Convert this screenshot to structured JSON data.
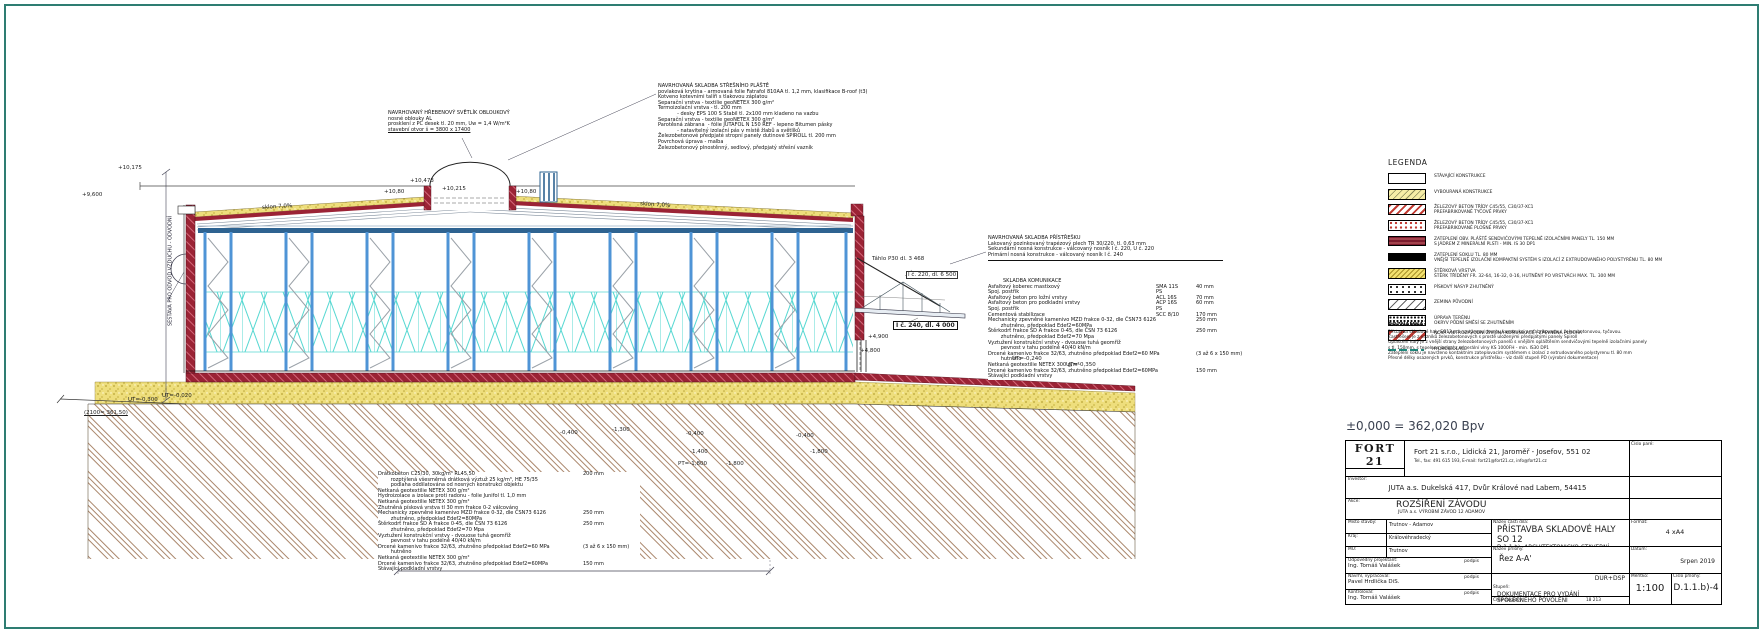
{
  "annotations": {
    "left_note": "SESTAVA PRO ODVOD VZDUCHU - ODVODNÍ",
    "svetlik": {
      "lines": [
        "NAVRHOVANÝ HŘEBENOVÝ SVĚTLÍK OBLOUKOVÝ",
        "nosné oblouky AL",
        "prosklení z PC desek tl. 20 mm, Uw = 1,4 W/m²K",
        "stavební otvor š = 3800 x 17400"
      ]
    },
    "stresni_plast": {
      "lines": [
        "NAVRHOVANÁ SKLADBA STŘEŠNÍHO PLÁŠTĚ",
        "povlaková krytina - armovaná folie Fatrafol 810AA tl. 1,2 mm, klasifikace B-roof (t3)",
        "Kotveno kotevními talíři s tlakovou záplatou",
        "Separační vrstva - textilie geoNETEX 300 g/m²",
        "Termoizolační vrstva - tl. 200 mm",
        "            - desky EPS 100 S Stabil tl. 2x100 mm kladeno na vazbu",
        "Separační vrstva - textilie geoNETEX 300 g/m²",
        "Parotěsná zábrana  - fólie JUTAFOL N 150 REF - lepeno Bitumen pásky",
        "            - natavitelný izolační pás v místě žlabů a světlíků",
        "Železobetonové předpjaté stropní panely dutinové SPIROLL tl. 200 mm",
        "Povrchová úprava - malba",
        "Železobetonový plnostěnný, sedlový, předpjatý střešní vazník"
      ]
    },
    "pristresek": {
      "lines": [
        "NAVRHOVANÁ SKLADBA PŘÍSTŘEŠKU",
        "Lakovaný pozinkovaný trapézový plech TR 30/220, tl. 0,63 mm",
        "Sekundární nosná konstrukce - válcovaný nosník I č. 220, U č. 220",
        "Primární nosná konstrukce - válcovaný nosník I č. 240"
      ]
    },
    "komunikace": {
      "title": "SKLADBA KOMUNIKACE",
      "lines": [
        {
          "t": "Asfaltový koberec mastixový",
          "c": "SMA 11S",
          "v": "40 mm"
        },
        {
          "t": "Spoj. postřik",
          "c": "PS"
        },
        {
          "t": "Asfaltový beton pro ložní vrstvy",
          "c": "ACL 16S",
          "v": "70 mm"
        },
        {
          "t": "Asfaltový beton pro podkladní vrstvy",
          "c": "ACP 16S",
          "v": "60 mm"
        },
        {
          "t": "Spoj. postřik",
          "c": "PS"
        },
        {
          "t": "Cementová stabilizace",
          "c": "SCC 8/10",
          "v": "170 mm"
        },
        {
          "t": "Mechanicky zpevněné kamenivo MZD frakce 0-32, dle ČSN73 6126",
          "v": "250 mm"
        },
        {
          "t": "        zhutněno, předpoklad Edef2=60MPa"
        },
        {
          "t": "Štěrkodrť frakce ŠD A frakce 0-45, dle ČSN 73 6126",
          "v": "250 mm"
        },
        {
          "t": "        zhutněno, předpoklad Edef2=70 Mpa"
        },
        {
          "t": "Vyztužení konstrukční vrstvy - dvouose tuhá geomříž"
        },
        {
          "t": "        pevnost v tahu podélně 40/40 kN/m"
        },
        {
          "t": "Drcené kamenivo frakce 32/63, zhutněno předpoklad Edef2=60 MPa",
          "v": "(3 až 6 x 150 mm)"
        },
        {
          "t": "        hutněno"
        },
        {
          "t": "Netkaná geotextilie NETEX 300 g/m²"
        },
        {
          "t": "Drcené kamenivo frakce 32/63, zhutněno předpoklad Edef2=60MPa",
          "v": "150 mm"
        },
        {
          "t": "Stávající podkladní vrstvy"
        }
      ]
    },
    "podlaha": {
      "lines": [
        {
          "t": "Drátkobeton C25/30, 30kg/m³ RL45,50",
          "v": "200 mm"
        },
        {
          "t": "        rozptýlená všesměrná drátková výztuž 25 kg/m³, HE 75/35"
        },
        {
          "t": "        podlaha oddilatována od nosných konstrukcí objektu"
        },
        {
          "t": "Netkaná geotextilie NETEX 300 g/m²"
        },
        {
          "t": "Hydroizolace a izolace proti radonu - folie Junifol tl. 1,0 mm"
        },
        {
          "t": "Netkaná geotextilie NETEX 300 g/m²"
        },
        {
          "t": "Zhutněná písková vrstva tl 30 mm frakce 0-2 válcováno"
        },
        {
          "t": "Mechanicky zpevněné kamenivo MZD frakce 0-32, dle ČSN73 6126",
          "v": "250 mm"
        },
        {
          "t": "        zhutněno, předpoklad Edef2=80MPa"
        },
        {
          "t": "Štěrkodrť frakce ŠD A frakce 0-45, dle ČSN 73 6126",
          "v": "250 mm"
        },
        {
          "t": "        zhutněno, předpoklad Edef2=70 Mpa"
        },
        {
          "t": "Vyztužení konstrukční vrstvy - dvouose tuhá geomříž"
        },
        {
          "t": "        pevnost v tahu podélně 40/40 kN/m"
        },
        {
          "t": "Drcené kamenivo frakce 32/63, zhutněno předpoklad Edef2=60 MPa",
          "v": "(3 až 6 x 150 mm)"
        },
        {
          "t": "        hutněno"
        },
        {
          "t": "Netkaná geotextilie NETEX 300 g/m²"
        },
        {
          "t": "Drcené kamenivo frakce 32/63, zhutněno předpoklad Edef2=60MPa",
          "v": "150 mm"
        },
        {
          "t": "Stávající podkladní vrstvy"
        }
      ]
    }
  },
  "drawing": {
    "labels": [
      {
        "x": 118,
        "y": 165,
        "t": "+10,175"
      },
      {
        "x": 82,
        "y": 192,
        "t": "+9,600"
      },
      {
        "x": 262,
        "y": 204,
        "t": "sklon 7,0%",
        "style": "rotl"
      },
      {
        "x": 640,
        "y": 202,
        "t": "sklon 7,0%",
        "style": "rotr"
      },
      {
        "x": 410,
        "y": 178,
        "t": "+10,473"
      },
      {
        "x": 442,
        "y": 186,
        "t": "+10,215"
      },
      {
        "x": 384,
        "y": 189,
        "t": "+10,80"
      },
      {
        "x": 516,
        "y": 189,
        "t": "+10,80"
      },
      {
        "x": 872,
        "y": 256,
        "t": "Táhlo P30 dl. 3 468"
      },
      {
        "x": 906,
        "y": 271,
        "t": "I č. 220, dl. 6 500",
        "style": "boxed"
      },
      {
        "x": 893,
        "y": 321,
        "t": "I č. 240, dl. 4 000",
        "style": "boxed-bold"
      },
      {
        "x": 868,
        "y": 334,
        "t": "+4,900"
      },
      {
        "x": 860,
        "y": 348,
        "t": "+4,800"
      },
      {
        "x": 128,
        "y": 397,
        "t": "UT=-0,300"
      },
      {
        "x": 162,
        "y": 393,
        "t": "UT=-0,020"
      },
      {
        "x": 84,
        "y": 410,
        "t": "(2100= 361,50)",
        "style": "ul"
      },
      {
        "x": 560,
        "y": 430,
        "t": "-0,400"
      },
      {
        "x": 612,
        "y": 427,
        "t": "-1,300"
      },
      {
        "x": 686,
        "y": 431,
        "t": "-0,400"
      },
      {
        "x": 690,
        "y": 449,
        "t": "-1,400"
      },
      {
        "x": 678,
        "y": 461,
        "t": "PT=-1,800"
      },
      {
        "x": 726,
        "y": 461,
        "t": "-1,800"
      },
      {
        "x": 796,
        "y": 433,
        "t": "-0,400"
      },
      {
        "x": 810,
        "y": 449,
        "t": "-1,800"
      },
      {
        "x": 1012,
        "y": 356,
        "t": "UT=-0,240"
      },
      {
        "x": 1066,
        "y": 362,
        "t": "UT=-0,350"
      }
    ]
  },
  "legend": {
    "title": "LEGENDA",
    "items": [
      {
        "swatch": "existing",
        "lines": [
          "STÁVAJÍCÍ KONSTRUKCE"
        ]
      },
      {
        "swatch": "demolished",
        "lines": [
          "VYBOURANÁ KONSTRUKCE"
        ]
      },
      {
        "swatch": "rc-linear",
        "lines": [
          "ŽELEZOVÝ BETON TŘÍDY C45/55, C30/37-XC1",
          "PREFABRIKOVANÉ TYČOVÉ PRVKY"
        ]
      },
      {
        "swatch": "rc-planar",
        "lines": [
          "ŽELEZOVÝ BETON TŘÍDY C45/55, C30/37-XC1",
          "PREFABRIKOVANÉ PLOŠNÉ PRVKY"
        ]
      },
      {
        "swatch": "sandwich",
        "lines": [
          "ZATEPLENÍ OBV. PLÁŠTĚ SENDVIČOVÝMI TEPELNĚ IZOLAČNÍMI PANELY TL. 150 MM",
          "S JÁDREM Z MINERÁLNÍ PLSTI - MIN. IS 30 DP1"
        ]
      },
      {
        "swatch": "plinth",
        "lines": [
          "ZATEPLENÍ SOKLU TL. 80 MM",
          "VNĚJŠÍ TEPELNĚ IZOLAČNÍ KOMPAKTNÍ SYSTÉM S IZOLACÍ Z EXTRUDOVANÉHO POLYSTYRÉNU TL. 80 MM"
        ]
      },
      {
        "swatch": "gravel",
        "lines": [
          "ŠTĚRKOVÁ VRSTVA",
          "ŠTĚRK TŘÍDĚNÝ FR. 32-64, 16-32, 0-16, HUTNĚNÝ PO VRSTVÁCH MAX. TL. 300 MM"
        ]
      },
      {
        "swatch": "sand",
        "lines": [
          "PÍSKOVÝ NÁSYP ZHUTNĚNÝ"
        ]
      },
      {
        "swatch": "soil",
        "lines": [
          "ZEMINA PŮVODNÍ"
        ]
      },
      {
        "swatch": "terrain",
        "lines": [
          "ÚPRAVA TERÉNU",
          "OKRYV PŮDNÍ SMĚSÍ SE ZHUTNĚNÍM"
        ]
      },
      {
        "swatch": "road",
        "lines": [
          "NOVÁ VNITROZÁVODNÍ ŽIVIČNÁ KOMUNIKACE , ZPEVNĚNÁ PLOCHA"
        ]
      },
      {
        "swatch": "hydro",
        "lines": [
          "HYDROIZOLACE"
        ]
      }
    ]
  },
  "poznamka": {
    "title": "POZNÁMKA:",
    "lines": [
      "Přístavba skladové haly SO12 má navrženou nosnou konstrukci prefabrikovanou, železobetonovou, tyčovou.",
      "Zastřešení je z vazníků železobetonových s prostě uloženými předpjatými panely Spiroll",
      "Opláštění haly je z vnější strany železobetonových panelů s vnějším opláštěním sendvičovými tepelně izolačními panely",
      "s tl. 150mm, s tepelnou izolací z minerální vlny KS 1000FH - min. IS30 DP1",
      "Zateplení soklu je navrženo kontaktním zateplovacím systémem s izolací z extrudovaného polystyrenu tl. 80 mm",
      "Přesné délky osazených prvků, konstrukce přístřešku - viz další stupeň PD (výrobní dokumentace)"
    ]
  },
  "elevation_ref": "±0,000 = 362,020 Bpv",
  "titleblock": {
    "logo_text": "FORT 21",
    "logo_sub": "s.r.o.",
    "cislo_pare_label": "Číslo paré:",
    "address_line1": "Fort 21 s.r.o., Lidická 21, Jaroměř - Josefov, 551 02",
    "address_line2": "Tel., fax: 491 615 193, E-mail: fort21@fort21.cz, info@fort21.cz",
    "investor_label": "Investor:",
    "investor": "JUTA a.s. Dukelská 417, Dvůr Králové nad Labem, 54415",
    "akce_label": "Akce:",
    "akce": "ROZŠÍŘENÍ ZÁVODU",
    "akce_sub": "JUTA a.s. VÝROBNÍ ZÁVOD 12 ADAMOV",
    "misto_label": "Místo stavby:",
    "misto": "Trutnov - Adamov",
    "kraj_label": "Kraj:",
    "kraj": "Královéhradecký",
    "mu_label": "MÚ:",
    "mu": "Trutnov",
    "odp_label": "Odpovědný projektant:",
    "odp_name": "Ing. Tomáš Valášek",
    "navrhl_label": "Navrhl, vypracoval:",
    "navrhl_name": "Pavel Hrdlička DiS.",
    "kontroloval_label": "Kontroloval:",
    "kontroloval_name": "Ing. Tomáš Valášek",
    "podpis": "podpis",
    "nazev_casti_label": "Název části díla:",
    "nazev_casti_1": "PŘÍSTAVBA SKLADOVÉ HALY SO 12",
    "nazev_casti_2": "D.1.1.b)- ARCHITEKTONICKO-STAVEBNÍ ŘEŠENÍ",
    "nazev_prilohy_label": "Název přílohy:",
    "nazev_prilohy": "Řez A-A'",
    "stupen_label": "Stupeň:",
    "stupen_1": "DOKUMENTACE PRO VYDÁNÍ",
    "stupen_2": "SPOLEČNÉHO POVOLENÍ",
    "stupen_code": "DUR+DSP",
    "cislo_zakazky_label": "Číslo zakázky:",
    "cislo_zakazky": "18 213",
    "format_label": "Formát:",
    "format": "4 xA4",
    "datum_label": "Datum:",
    "datum": "Srpen 2019",
    "meritko_label": "Měřítko:",
    "meritko": "1:100",
    "cislo_prilohy_label": "Číslo přílohy:",
    "cislo_prilohy": "D.1.1.b)-4"
  }
}
